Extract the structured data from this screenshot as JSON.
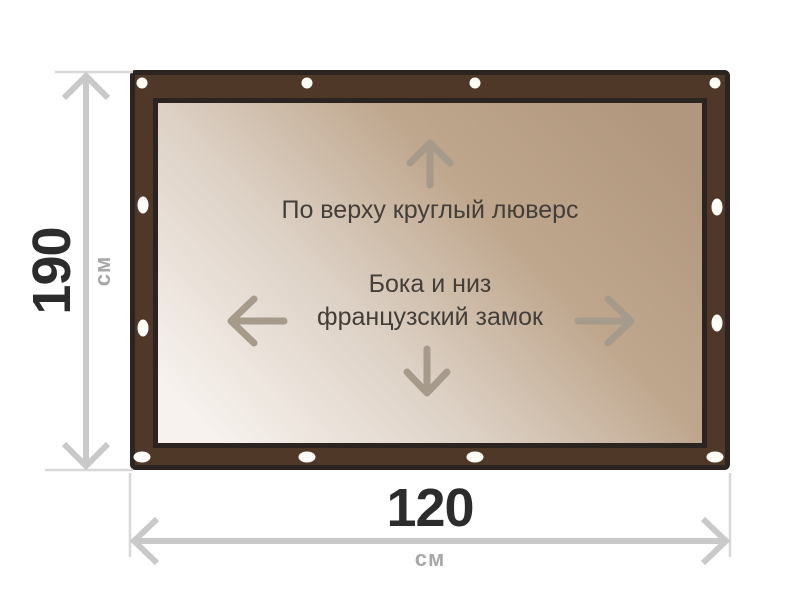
{
  "diagram": {
    "annotations": {
      "top_edge_note": "По верху круглый люверс",
      "sides_note_line1": "Бока и низ",
      "sides_note_line2": "французский замок"
    },
    "dimensions": {
      "height": {
        "value": "190",
        "unit": "см"
      },
      "width": {
        "value": "120",
        "unit": "см"
      }
    },
    "grommet_counts": {
      "top": 4,
      "bottom": 4,
      "left": 2,
      "right": 2
    },
    "icons": {
      "up_arrow": "up-arrow-icon",
      "down_arrow": "down-arrow-icon",
      "left_arrow": "left-arrow-icon",
      "right_arrow": "right-arrow-icon",
      "grommet": "grommet-icon"
    },
    "colors": {
      "frame": "#503828",
      "frame_outline": "#2b2420",
      "canvas_light": "#f7f2ee",
      "canvas_mid_light": "#ddd1c5",
      "canvas_mid_dark": "#bfa78e",
      "canvas_dark": "#b0977d",
      "grommet": "#fffdf8",
      "inner_arrow": "#a69a8b",
      "dimension_line": "#c9c9c9",
      "extension_line": "#d8d8d8",
      "dimension_value_text": "#2c2c2c",
      "dimension_unit_text": "#a8a8a8",
      "note_text": "#443e38"
    }
  }
}
